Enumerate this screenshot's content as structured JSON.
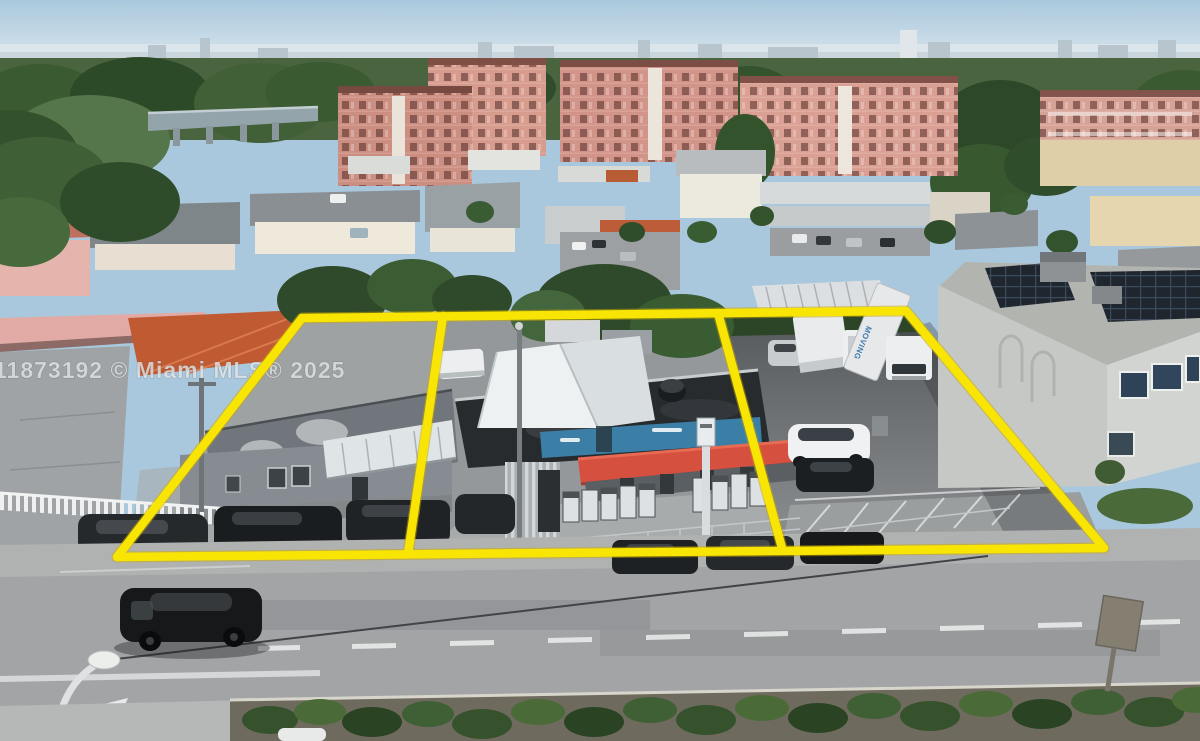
{
  "meta": {
    "type": "aerial-drone-photograph",
    "subject": "commercial-property-listing-three-parcels-outlined"
  },
  "watermark": {
    "text": "11873192 © Miami MLS® 2025"
  },
  "vehicles": {
    "trailer_label": "MOVING"
  },
  "colors": {
    "boundary_yellow": "#f8e504",
    "boundary_under": "#c9a800",
    "awning_red": "#d5503e",
    "sign_blue": "#3b7fa6",
    "sky_top": "#a9c8dd",
    "sky_horizon": "#e3ebf0",
    "condo_salmon": "#d29488",
    "hedge_green": "#3a5a30",
    "asphalt": "#a2a4a6"
  }
}
